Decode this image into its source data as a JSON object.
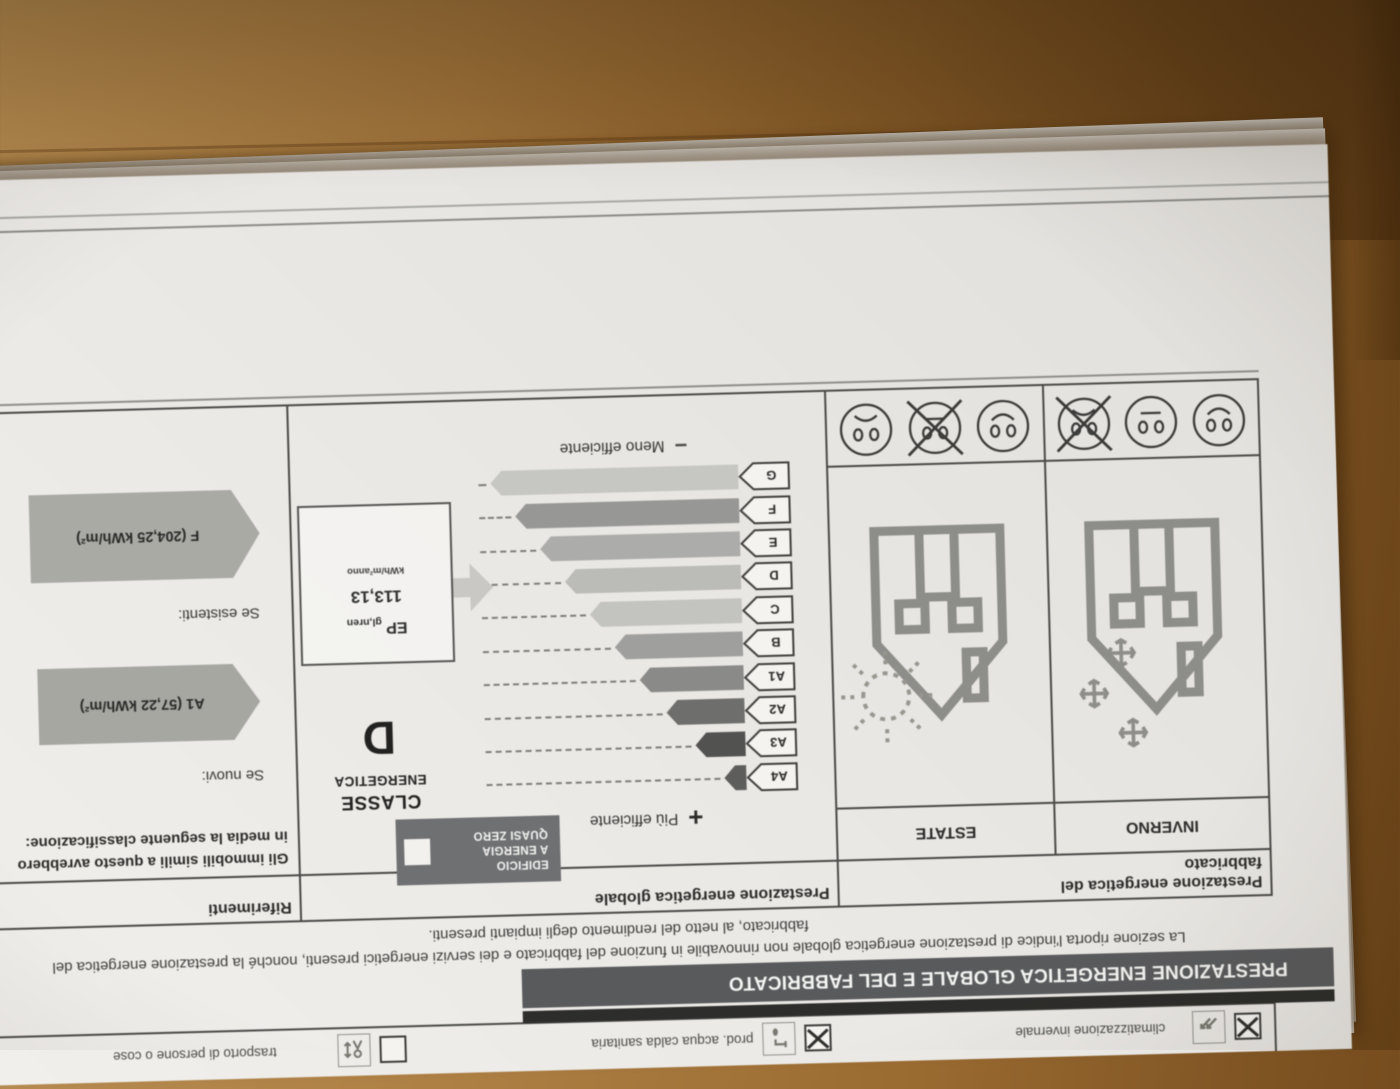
{
  "photo": {
    "desk_color": "#a97c3f",
    "desk_dark": "#6a4318",
    "paper_color": "#ece9e6",
    "header_bar_color": "#595a5c",
    "badge_color": "#6f7072",
    "reference_arrow_color": "#a7a7a2",
    "orientation": "document photographed upside down on wooden desk"
  },
  "services_row": {
    "items": [
      {
        "label": "climatizzazione invernale",
        "icon": "winter-air-icon",
        "checked": true
      },
      {
        "label": "prod. acqua calda sanitaria",
        "icon": "hot-water-icon",
        "checked": true
      },
      {
        "label": "trasporto di persone o cose",
        "icon": "lift-icon",
        "checked": false
      }
    ]
  },
  "section": {
    "header": "PRESTAZIONE ENERGETICA GLOBALE E DEL FABBRICATO",
    "intro_line1": "La sezione riporta l'indice di prestazione energetica globale non rinnovabile in funzione del fabbricato e dei servizi energetici presenti, nonché la prestazione energetica del",
    "intro_line2": "fabbricato, al netto del rendimento degli impianti presenti."
  },
  "table": {
    "fabbricato_header": "Prestazione energetica del fabbricato",
    "globale_header": "Prestazione energetica globale",
    "riferimenti_header": "Riferimenti",
    "inverno_label": "INVERNO",
    "estate_label": "ESTATE",
    "smiley_order": [
      "smile",
      "neutral",
      "frown"
    ],
    "inverno_crossed_index": 2,
    "estate_crossed_index": 1
  },
  "globale": {
    "plus": "+",
    "piu_efficiente": "Più efficiente",
    "minus": "−",
    "meno_efficiente": "Meno efficiente",
    "nzeb_line1": "EDIFICIO",
    "nzeb_line2": "A ENERGIA",
    "nzeb_line3": "QUASI ZERO",
    "nzeb_checked": false,
    "classe_line1": "CLASSE",
    "classe_line2": "ENERGETICA",
    "classe_value": "D",
    "ep_label": "EP",
    "ep_sub": "gl,nren",
    "ep_value": "113,13",
    "ep_unit": "kWh/m²anno",
    "scale": [
      {
        "class": "A4",
        "bar": 22,
        "color": "#5d5d5b"
      },
      {
        "class": "A3",
        "bar": 50,
        "color": "#525250"
      },
      {
        "class": "A2",
        "bar": 78,
        "color": "#6e6e6c"
      },
      {
        "class": "A1",
        "bar": 104,
        "color": "#8a8a88"
      },
      {
        "class": "B",
        "bar": 128,
        "color": "#9f9f9d"
      },
      {
        "class": "C",
        "bar": 152,
        "color": "#c3c3c0"
      },
      {
        "class": "D",
        "bar": 176,
        "color": "#bbbbb8"
      },
      {
        "class": "E",
        "bar": 200,
        "color": "#acacaa"
      },
      {
        "class": "F",
        "bar": 224,
        "color": "#979795"
      },
      {
        "class": "G",
        "bar": 248,
        "color": "#c6c6c3"
      }
    ]
  },
  "riferimenti": {
    "text": "Gli immobili simili a questo avrebbero in media la seguente classificazione:",
    "se_nuovi": "Se nuovi:",
    "nuovi_value": "A1 (57,22 kWh/m²)",
    "se_esistenti": "Se esistenti:",
    "esistenti_value": "F (204,25 kWh/m²)"
  }
}
